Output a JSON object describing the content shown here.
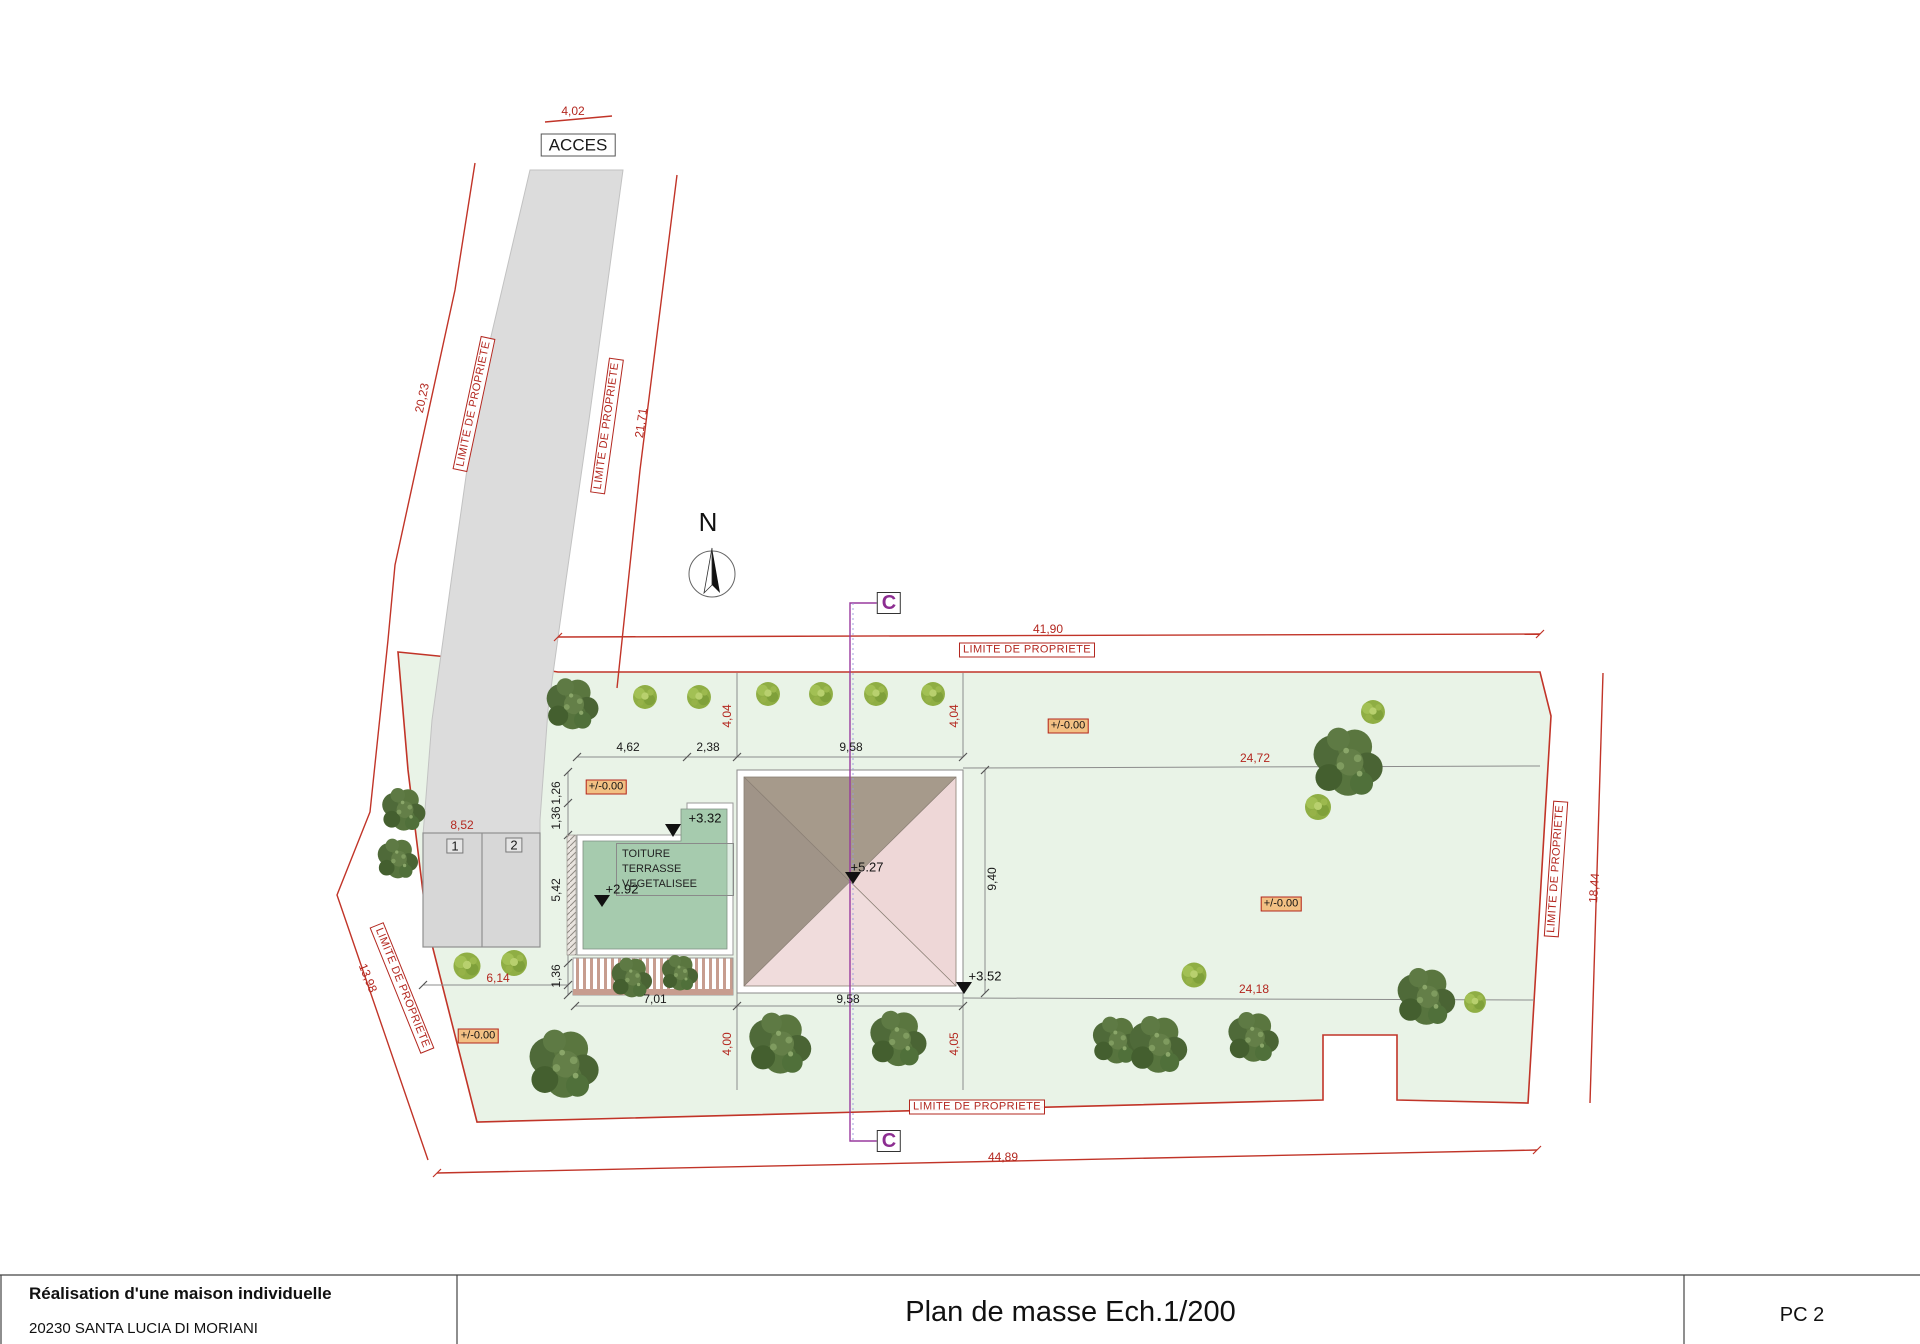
{
  "labels": {
    "acces": "ACCES",
    "limite": "LIMITE DE PROPRIETE",
    "north": "N",
    "section": "C",
    "toiture1": "TOITURE TERRASSE",
    "toiture2": "VEGETALISEE",
    "p1": "1",
    "p2": "2"
  },
  "dims": {
    "top_access": "4,02",
    "west_upper": "20,23",
    "west_inner": "21,71",
    "north": "41,90",
    "south": "44,89",
    "east": "18,44",
    "southwest": "13,98",
    "a462": "4,62",
    "a238": "2,38",
    "a958t": "9,58",
    "a958b": "9,58",
    "a940": "9,40",
    "a126": "1,26",
    "a136a": "1,36",
    "a542": "5,42",
    "a136b": "1,36",
    "a701": "7,01",
    "a852": "8,52",
    "a614": "6,14",
    "a2472": "24,72",
    "a2418": "24,18",
    "a404l": "4,04",
    "a404r": "4,04",
    "a400": "4,00",
    "a405": "4,05"
  },
  "levels": {
    "zero": "+/-0.00",
    "l332": "+3.32",
    "l292": "+2.92",
    "l527": "+5.27",
    "l352": "+3.52"
  },
  "title_block": {
    "project": "Réalisation d'une maison individuelle",
    "address": "20230 SANTA LUCIA DI MORIANI",
    "sheet_title": "Plan de masse Ech.1/200",
    "sheet_number": "PC 2"
  },
  "colors": {
    "property_red": "#c13428",
    "section_purple": "#993a9e",
    "terrain_green": "#e9f3e7",
    "roof_taupe": "#a69a8b",
    "roof_pink": "#f0dcdc",
    "terrace_green": "#a6cbae",
    "level_badge_orange": "#f2c083",
    "asphalt_gray": "#dcdcdc"
  }
}
